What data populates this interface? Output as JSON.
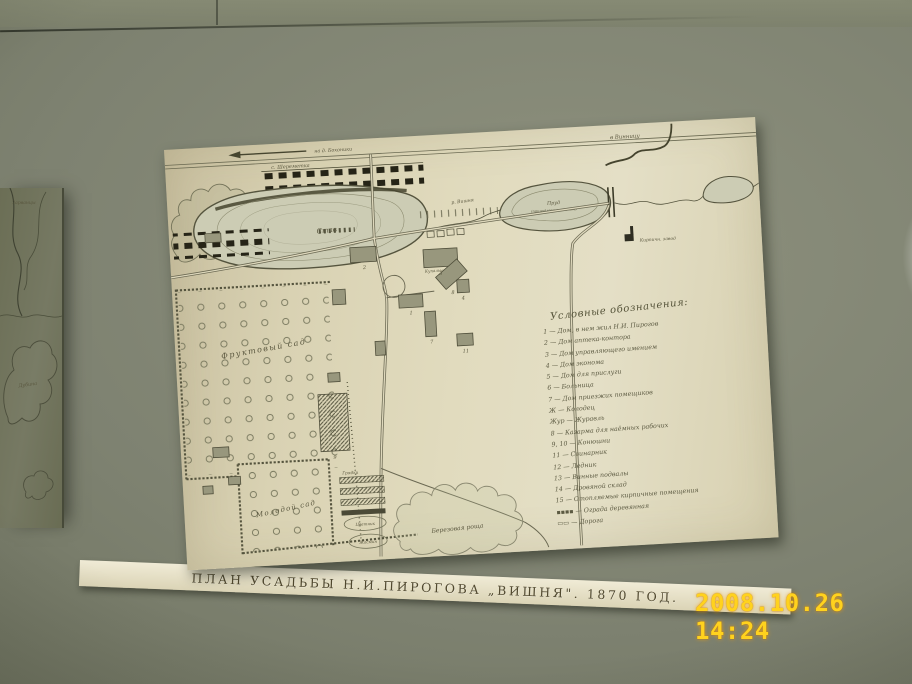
{
  "scene": {
    "camera_timestamp": "2008.10.26 14:24"
  },
  "caption": {
    "title": "ПЛАН УСАДЬБЫ Н.И.ПИРОГОВА „ВИШНЯ\". 1870 ГОД."
  },
  "map": {
    "labels": {
      "road_to_village": "на д. Бохоники",
      "village": "с. Шереметка",
      "pasture": "Выгон",
      "big_pond": "Став",
      "bathing": "Купальня",
      "river": "р. Вишня",
      "estate_pond_1": "Пруд",
      "estate_pond_2": "(принадлеж. к имению)",
      "to_vinnitsa": "в Винницу",
      "brick_factory": "Кирпичн. завод",
      "fruit_orchard": "Фруктовый сад",
      "young_orchard": "Молодой сад",
      "beds": "Грядки",
      "flower_bed": "Цветник",
      "jasmine": "Жасмин",
      "birch_grove": "Березовая роща"
    },
    "building_numbers": [
      "2",
      "3",
      "8",
      "4",
      "1",
      "7",
      "9",
      "11"
    ],
    "legend": {
      "title": "Условные обозначения:",
      "items": [
        "1 — Дом, в нем жил Н.И. Пирогов",
        "2 — Дом аптека-контора",
        "3 — Дом управляющего имением",
        "4 — Дом эконома",
        "5 — Дом для прислуги",
        "6 — Больница",
        "7 — Дом приезжих помещиков",
        "Ж — Колодец",
        "Жур — Журавль",
        "8 — Казарма для наёмных рабочих",
        "9, 10 — Конюшни",
        "11 — Свинарник",
        "12 — Ледник",
        "13 — Винные подвалы",
        "14 — Дровяной склад",
        "15 — Отопляемые кирпичные помещения",
        "▪▪▪▪ — Ограда деревянная",
        "▭▭ — Дорога"
      ]
    }
  },
  "left_exhibit": {
    "labels": {
      "village": "Зарванцы",
      "grove": "Дубина"
    }
  },
  "colors": {
    "timestamp": "#ffd21e",
    "paper": "#ded8bc",
    "wall": "#7d8171"
  }
}
